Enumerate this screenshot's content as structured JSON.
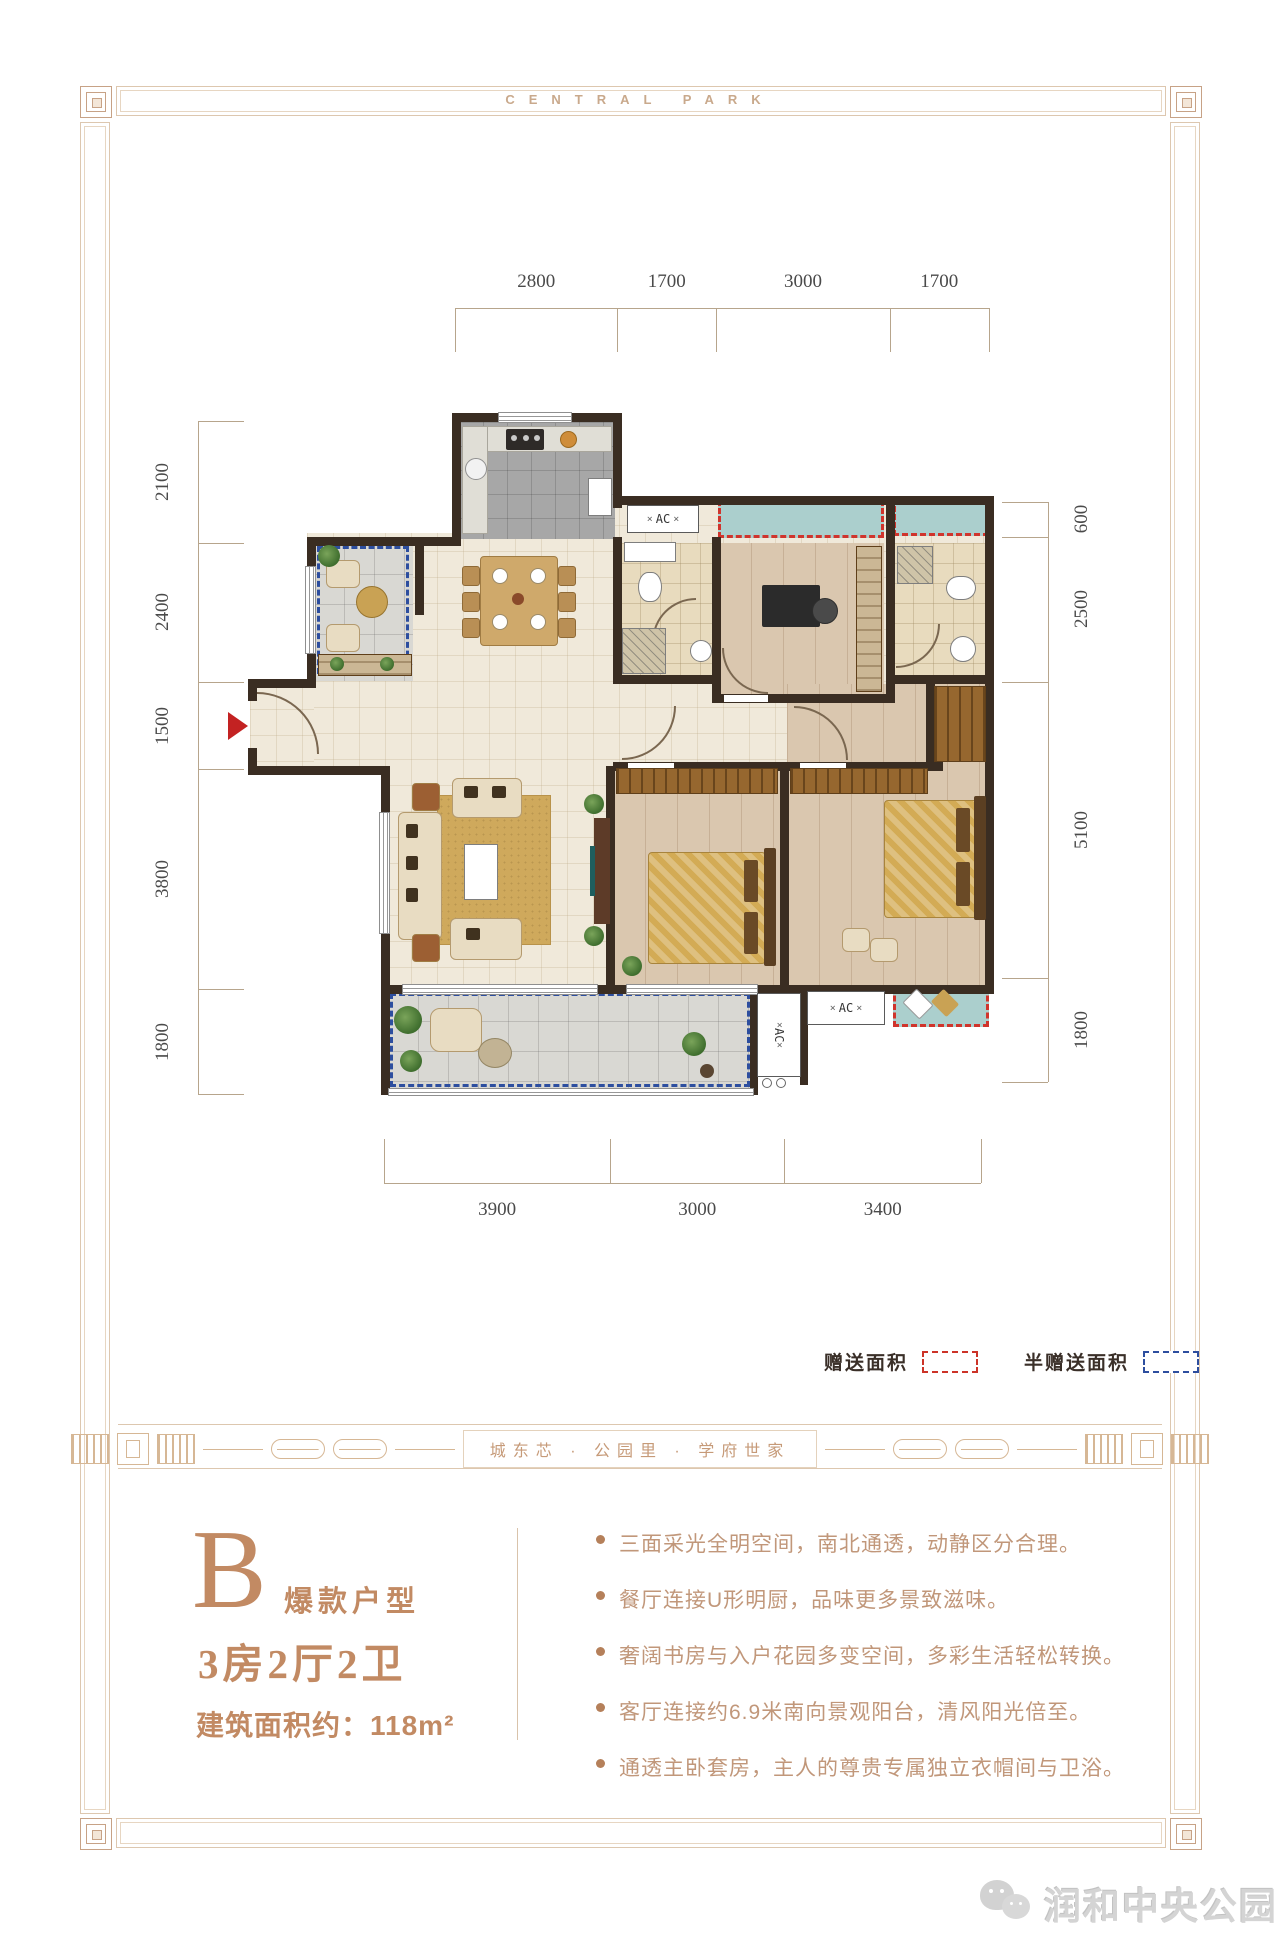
{
  "frame": {
    "brand": "CENTRAL PARK"
  },
  "plan": {
    "dims": {
      "top": [
        "2800",
        "1700",
        "3000",
        "1700"
      ],
      "bottom": [
        "3900",
        "3000",
        "3400"
      ],
      "left": [
        "2100",
        "2400",
        "1500",
        "3800",
        "1800"
      ],
      "right": [
        "600",
        "2500",
        "5100",
        "1800"
      ]
    },
    "ac_label": "AC",
    "legend": {
      "gift": "赠送面积",
      "half_gift": "半赠送面积"
    }
  },
  "divider": {
    "slogan": "城东芯 · 公园里 · 学府世家"
  },
  "unit": {
    "letter": "B",
    "tag": "爆款户型",
    "layout": "3房2厅2卫",
    "area": "建筑面积约：118m²",
    "features": [
      "三面采光全明空间，南北通透，动静区分合理。",
      "餐厅连接U形明厨，品味更多景致滋味。",
      "奢阔书房与入户花园多变空间，多彩生活轻松转换。",
      "客厅连接约6.9米南向景观阳台，清风阳光倍至。",
      "通透主卧套房，主人的尊贵专属独立衣帽间与卫浴。"
    ]
  },
  "watermark": {
    "text": "润和中央公园"
  },
  "colors": {
    "accent": "#c28a63",
    "wall": "#3a2d22",
    "gift_dash": "#d0342c",
    "half_gift_dash": "#2d4e9f",
    "bay_window": "#abcfcd"
  }
}
